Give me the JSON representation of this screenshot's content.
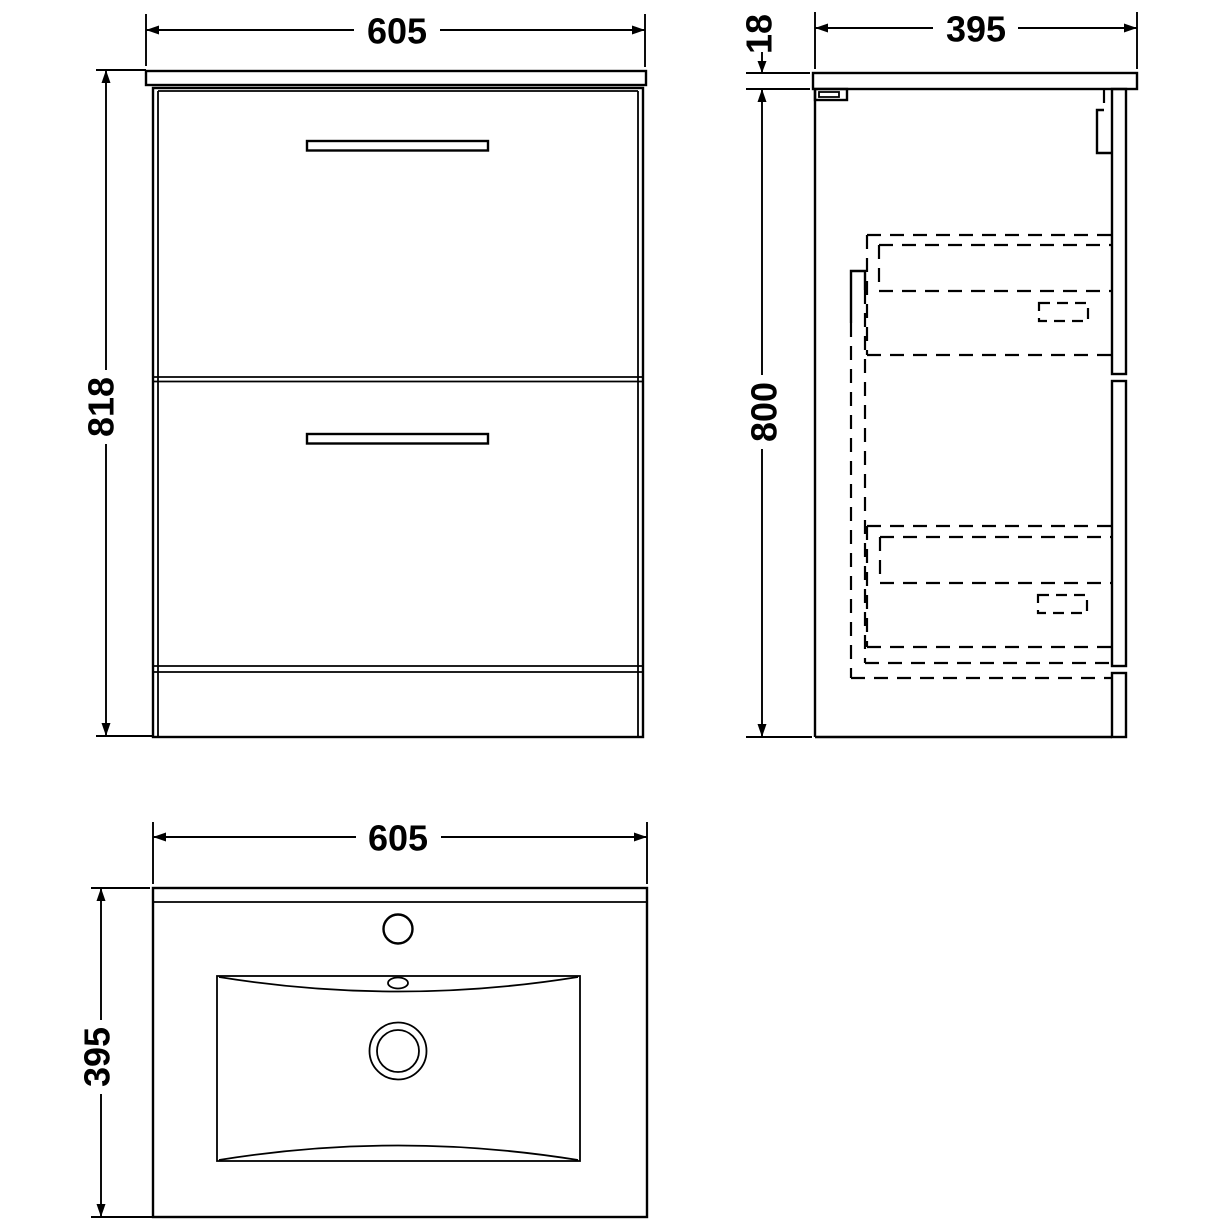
{
  "drawing": {
    "background_color": "#ffffff",
    "line_color": "#000000",
    "views": {
      "front": {
        "width": "605",
        "height": "818"
      },
      "side": {
        "depth": "395",
        "worktop_thickness": "18",
        "carcass_height": "800"
      },
      "plan": {
        "width": "605",
        "depth": "395"
      }
    }
  }
}
